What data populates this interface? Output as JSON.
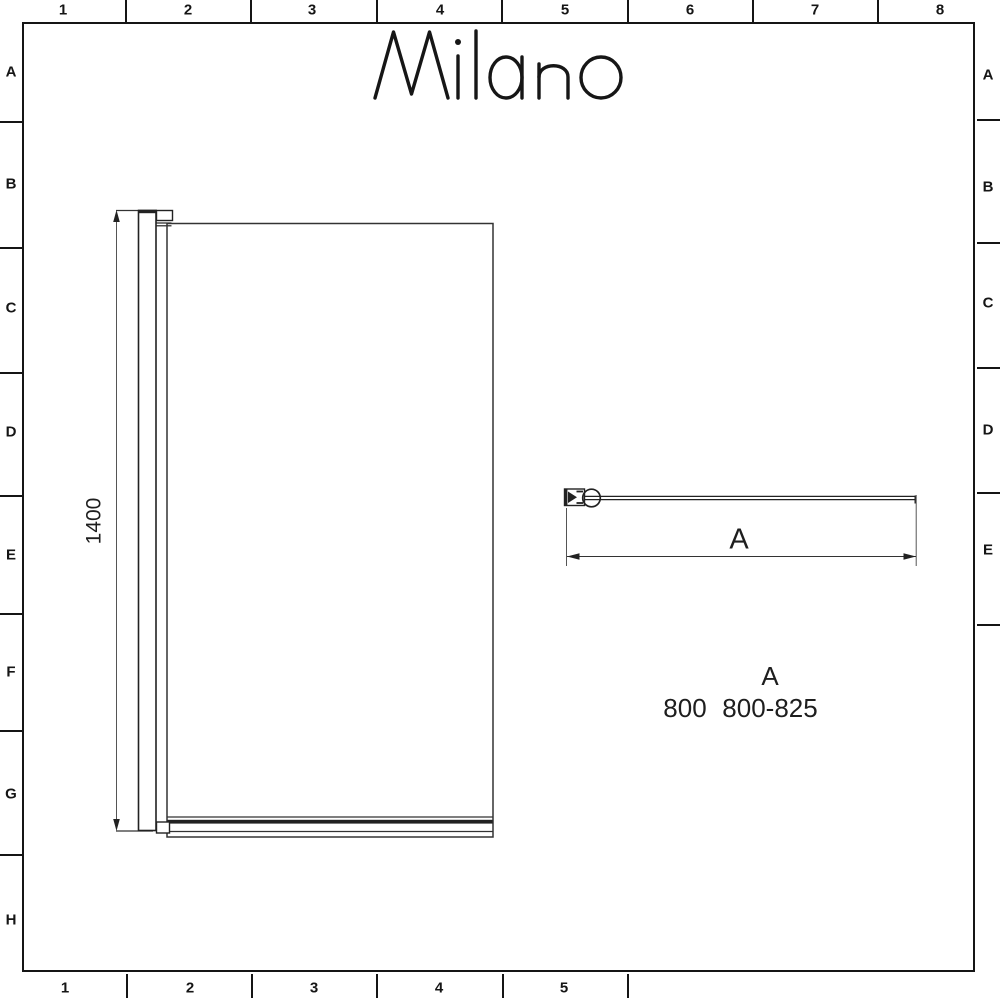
{
  "window": {
    "background": "#ffffff",
    "line_color": "#1a1a1a"
  },
  "brand": {
    "logo_text": "Milano"
  },
  "frame": {
    "top_labels": [
      "1",
      "2",
      "3",
      "4",
      "5",
      "6",
      "7",
      "8"
    ],
    "bottom_labels": [
      "1",
      "2",
      "3",
      "4",
      "5"
    ],
    "left_labels": [
      "A",
      "B",
      "C",
      "D",
      "E",
      "F",
      "G",
      "H"
    ],
    "right_labels": [
      "A",
      "B",
      "C",
      "D",
      "E"
    ]
  },
  "front_view": {
    "height_dimension": "1400"
  },
  "plan_view": {
    "width_dimension_label": "A"
  },
  "size_table": {
    "column_header": "A",
    "rows": [
      {
        "size": "800",
        "dimension_a_range": "800-825"
      }
    ]
  }
}
